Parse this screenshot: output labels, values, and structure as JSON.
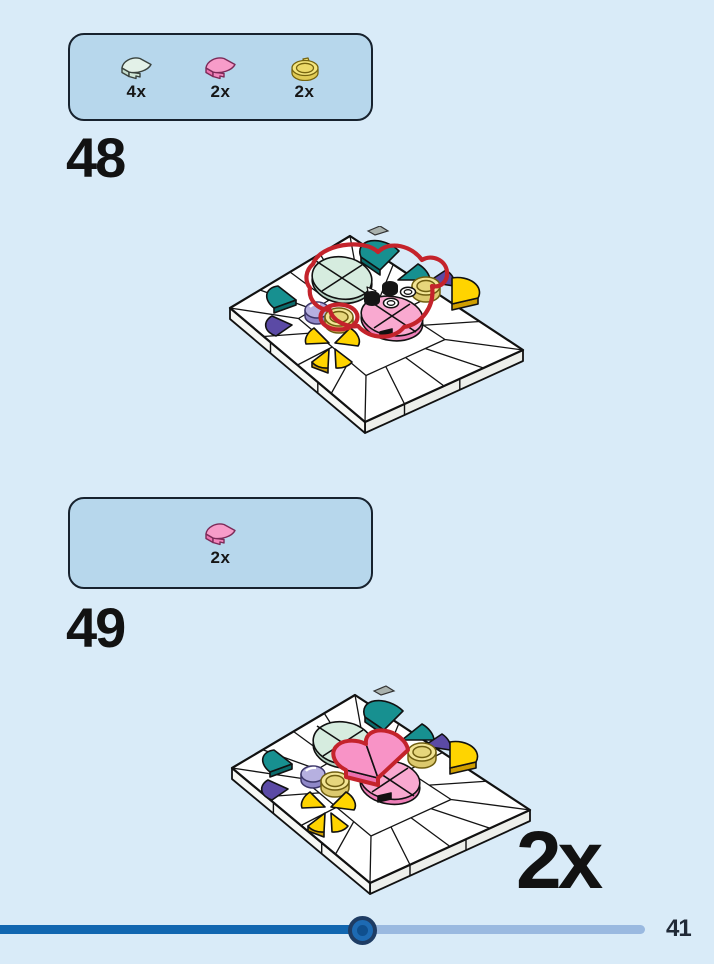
{
  "page": {
    "background": "#d9ebf8",
    "number": "41"
  },
  "steps": [
    {
      "number": "48",
      "parts": [
        {
          "id": "quarter-tile-light-aqua",
          "count": "4x",
          "color": "#e3f1e8"
        },
        {
          "id": "quarter-tile-pink",
          "count": "2x",
          "color": "#f79cc9"
        },
        {
          "id": "round-tile-trans-yellow",
          "count": "2x",
          "color": "#f5e67e"
        }
      ]
    },
    {
      "number": "49",
      "parts": [
        {
          "id": "quarter-tile-pink",
          "count": "2x",
          "color": "#f79cc9"
        }
      ],
      "multiplier": "2x"
    }
  ],
  "slider": {
    "progress_percent": 55,
    "fill_color": "#1166b0",
    "track_color": "#9ab9e0"
  }
}
